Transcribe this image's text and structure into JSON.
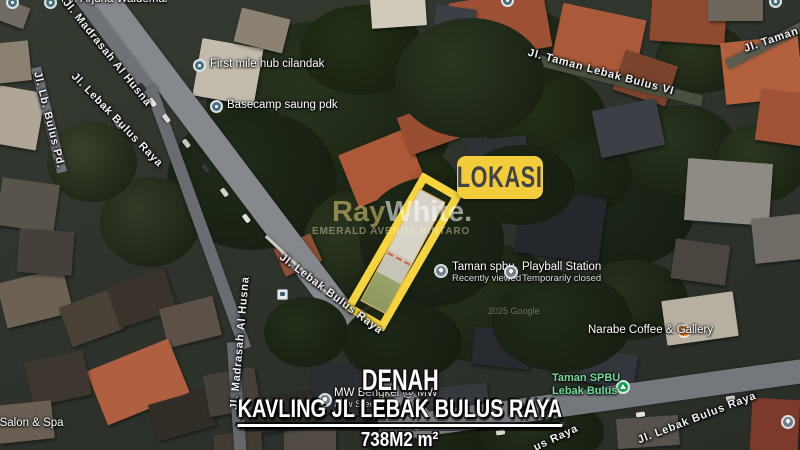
{
  "overlay": {
    "lokasi_badge": "LOKASI",
    "caption_line1": "DENAH",
    "caption_line2": "KAVLING JL LEBAK BULUS RAYA",
    "caption_line3": "738M2 m²"
  },
  "map": {
    "attribution": "2025 Google",
    "watermark": {
      "brand_left": "Ray",
      "brand_right": "White.",
      "subtitle": "EMERALD AVENUE BINTARO"
    },
    "poi_labels": [
      {
        "id": "pin-top-left",
        "icon": "teal",
        "ix": 6,
        "iy": -4,
        "lines": [],
        "tx": 0,
        "ty": 0
      },
      {
        "id": "pt-arjuna-waldemar",
        "icon": "teal",
        "ix": 44,
        "iy": -4,
        "lines": [
          "PT. Arjuna Waldemar"
        ],
        "tx": 61,
        "ty": -7
      },
      {
        "id": "first-mile-hub-cilandak",
        "icon": "teal",
        "ix": 193,
        "iy": 59,
        "lines": [
          "First mile hub cilandak"
        ],
        "tx": 210,
        "ty": 58
      },
      {
        "id": "basecamp-saung-pdk",
        "icon": "teal",
        "ix": 210,
        "iy": 100,
        "lines": [
          "Basecamp saung pdk"
        ],
        "tx": 227,
        "ty": 99
      },
      {
        "id": "pin-top-center",
        "icon": "teal",
        "ix": 501,
        "iy": -6,
        "lines": [],
        "tx": 0,
        "ty": 0
      },
      {
        "id": "pin-top-right",
        "icon": "teal",
        "ix": 769,
        "iy": -5,
        "lines": [],
        "tx": 0,
        "ty": 0
      },
      {
        "id": "taman-spbu-recent",
        "icon": "pin",
        "ix": 434,
        "iy": 264,
        "lines": [
          "Taman spbu",
          "Recently viewed"
        ],
        "sub": true,
        "tx": 452,
        "ty": 261
      },
      {
        "id": "playball-station",
        "icon": "pin",
        "ix": 504,
        "iy": 265,
        "lines": [
          "Playball Station",
          "Temporarily closed"
        ],
        "sub": true,
        "tx": 522,
        "ty": 261
      },
      {
        "id": "narabe-coffee-gallery",
        "icon": "coffee",
        "ix": 677,
        "iy": 324,
        "lines": [
          "Narabe Coffee & Gallery"
        ],
        "tx": 588,
        "ty": 324
      },
      {
        "id": "taman-spbu-lebak-bulus",
        "icon": "park",
        "ix": 616,
        "iy": 380,
        "lines": [
          "Taman SPBU",
          "Lebak Bulus"
        ],
        "green": true,
        "tx": 552,
        "ty": 372
      },
      {
        "id": "mw-bengkel",
        "icon": "pin",
        "ix": 318,
        "iy": 393,
        "lines": [
          "MW Bengkel @ MW",
          "Pow Steer"
        ],
        "sub": true,
        "behind": true,
        "tx": 334,
        "ty": 387
      },
      {
        "id": "salon-spa",
        "icon": "none",
        "ix": 0,
        "iy": 0,
        "lines": [
          "a Salon & Spa"
        ],
        "tx": -10,
        "ty": 417
      },
      {
        "id": "pin-right-edge",
        "icon": "pin",
        "ix": 781,
        "iy": 415,
        "lines": [],
        "tx": 0,
        "ty": 0
      },
      {
        "id": "bus-stop",
        "icon": "bus",
        "ix": 277,
        "iy": 289,
        "lines": [],
        "tx": 0,
        "ty": 0
      }
    ],
    "road_labels": [
      {
        "text": "Jl. Madrasah Al Husna",
        "x": 107,
        "y": 53,
        "rot": 51
      },
      {
        "text": "Jl. Lb. Bulus Pd.",
        "x": 49,
        "y": 120,
        "rot": 76
      },
      {
        "text": "Jl. Lebak Bulus Raya",
        "x": 117,
        "y": 120,
        "rot": 46
      },
      {
        "text": "Jl. Taman Lebak Bulus VI",
        "x": 601,
        "y": 72,
        "rot": 15
      },
      {
        "text": "Jl. Taman Le",
        "x": 780,
        "y": 37,
        "rot": -19
      },
      {
        "text": "Jl. Lebak Bulus Raya",
        "x": 331,
        "y": 294,
        "rot": 37
      },
      {
        "text": "Jl. Madrasah Al Husna",
        "x": 240,
        "y": 343,
        "rot": -85
      },
      {
        "text": "Jl. Lebak Bulus Raya",
        "x": 697,
        "y": 418,
        "rot": -21
      },
      {
        "text": "us Raya",
        "x": 556,
        "y": 438,
        "rot": -25
      }
    ]
  },
  "colors": {
    "badge_yellow": "#f3cc3b",
    "plot_outline_yellow": "#f6d43e",
    "park_label_green": "#72dd9b",
    "poi_orange": "#e8710a",
    "poi_teal": "#49707e",
    "poi_gray": "#6e7f8a",
    "park_green": "#129d55"
  }
}
